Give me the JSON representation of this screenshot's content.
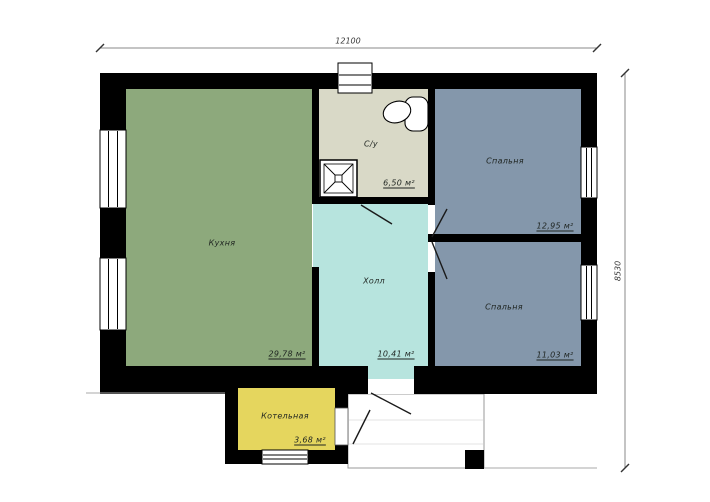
{
  "plan": {
    "title": "house-floor-plan",
    "dimension_top": "12100",
    "dimension_right": "8530",
    "rooms": [
      {
        "id": "kitchen",
        "name": "Кухня",
        "area": "29,78 м²",
        "color": "#8da97c"
      },
      {
        "id": "bathroom",
        "name": "С/у",
        "area": "6,50 м²",
        "color": "#d9d9c7"
      },
      {
        "id": "hall",
        "name": "Холл",
        "area": "10,41 м²",
        "color": "#b7e4de"
      },
      {
        "id": "bedroom-top",
        "name": "Спальня",
        "area": "12,95 м²",
        "color": "#8497ab"
      },
      {
        "id": "bedroom-bottom",
        "name": "Спальня",
        "area": "11,03 м²",
        "color": "#8497ab"
      },
      {
        "id": "boiler-room",
        "name": "Котельная",
        "area": "3,68 м²",
        "color": "#e5d65e"
      }
    ],
    "colors": {
      "walls": "#000000",
      "background": "#ffffff",
      "porch_outline": "#999999",
      "dimension_line": "#8a8a8a"
    },
    "fixtures": [
      "shower",
      "toilet",
      "entrance-porch",
      "porch-pillar"
    ]
  }
}
